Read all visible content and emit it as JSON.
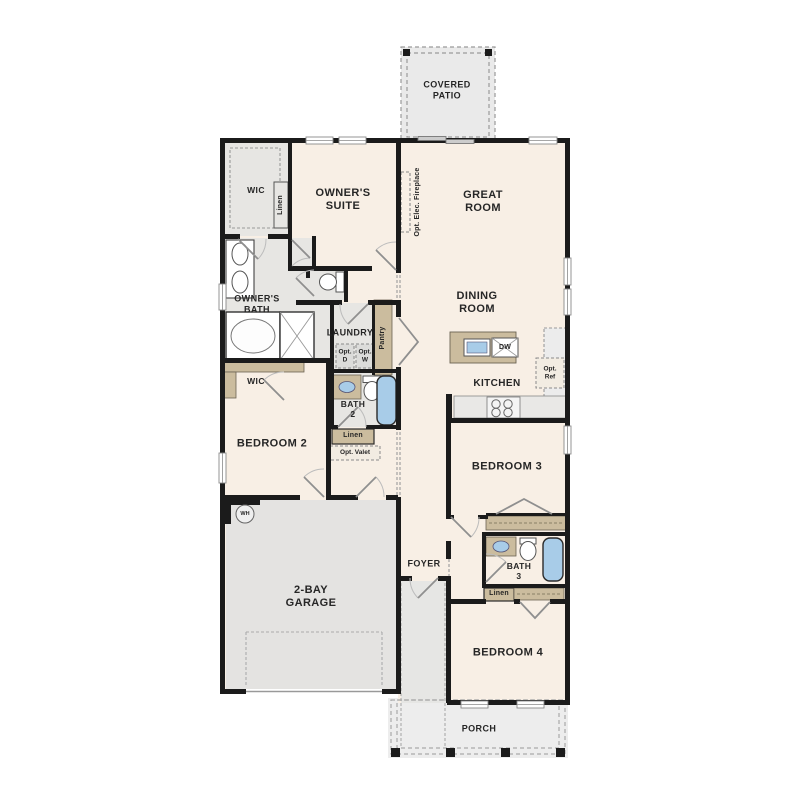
{
  "colors": {
    "wall": "#1b1b1b",
    "cream": "#f8efe5",
    "gray_room": "#e7e6e3",
    "tan": "#cbbc9e",
    "blue": "#a8cce8",
    "patio": "#eaeaea",
    "porch": "#ededed",
    "hall": "#e6e6e4",
    "door": "#8f8f8f"
  },
  "labels": {
    "covered_patio": "COVERED\nPATIO",
    "owners_suite": "OWNER'S\nSUITE",
    "great_room": "GREAT\nROOM",
    "dining_room": "DINING\nROOM",
    "kitchen": "KITCHEN",
    "owners_bath": "OWNER'S\nBATH",
    "laundry": "LAUNDRY",
    "foyer": "FOYER",
    "porch": "PORCH",
    "garage": "2-BAY\nGARAGE",
    "bedroom2": "BEDROOM 2",
    "bedroom3": "BEDROOM 3",
    "bedroom4": "BEDROOM 4",
    "bath2": "BATH\n2",
    "bath3": "BATH\n3",
    "wic_owner": "WIC",
    "wic_bed2": "WIC",
    "linen_wic": "Linen",
    "linen_bath2": "Linen",
    "linen_bath3": "Linen",
    "opt_valet": "Opt. Valet",
    "pantry": "Pantry",
    "fireplace": "Opt. Elec. Fireplace",
    "opt_d": "Opt.\nD",
    "opt_w": "Opt.\nW",
    "opt_ref": "Opt.\nRef",
    "dw": "DW",
    "wh": "WH"
  }
}
